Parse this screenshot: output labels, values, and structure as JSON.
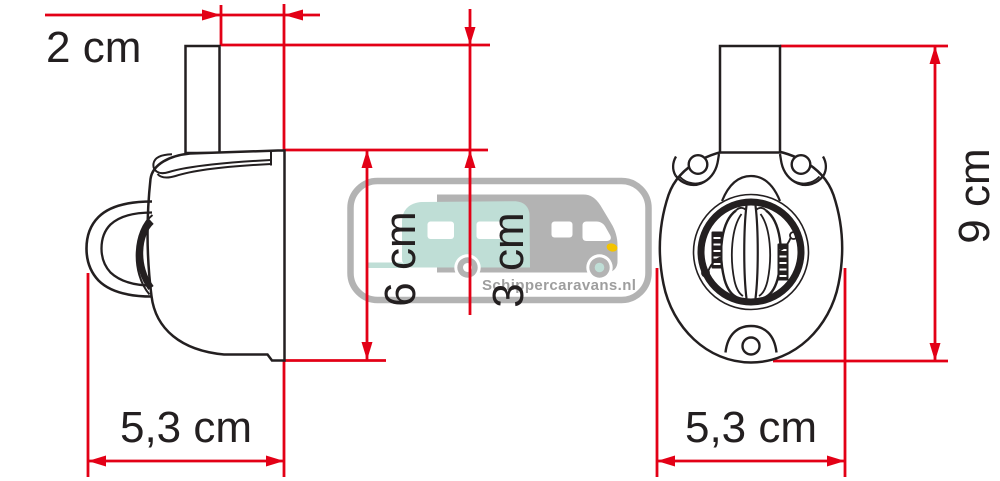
{
  "dimensions": {
    "top_offset": {
      "label": "2 cm"
    },
    "body_height": {
      "label": "6 cm"
    },
    "stem_height": {
      "label": "3 cm"
    },
    "side_width": {
      "label": "5,3 cm"
    },
    "total_height": {
      "label": "9 cm"
    },
    "front_width": {
      "label": "5,3 cm"
    }
  },
  "watermark": {
    "text": "Schippercaravans.nl"
  },
  "colors": {
    "dimension_red": "#e30016",
    "line_black": "#231f20",
    "watermark_gray": "#b3b3b3",
    "watermark_teal": "#bfded6",
    "watermark_text_gray": "#9e9e9e",
    "headlight_yellow": "#f3c300"
  }
}
